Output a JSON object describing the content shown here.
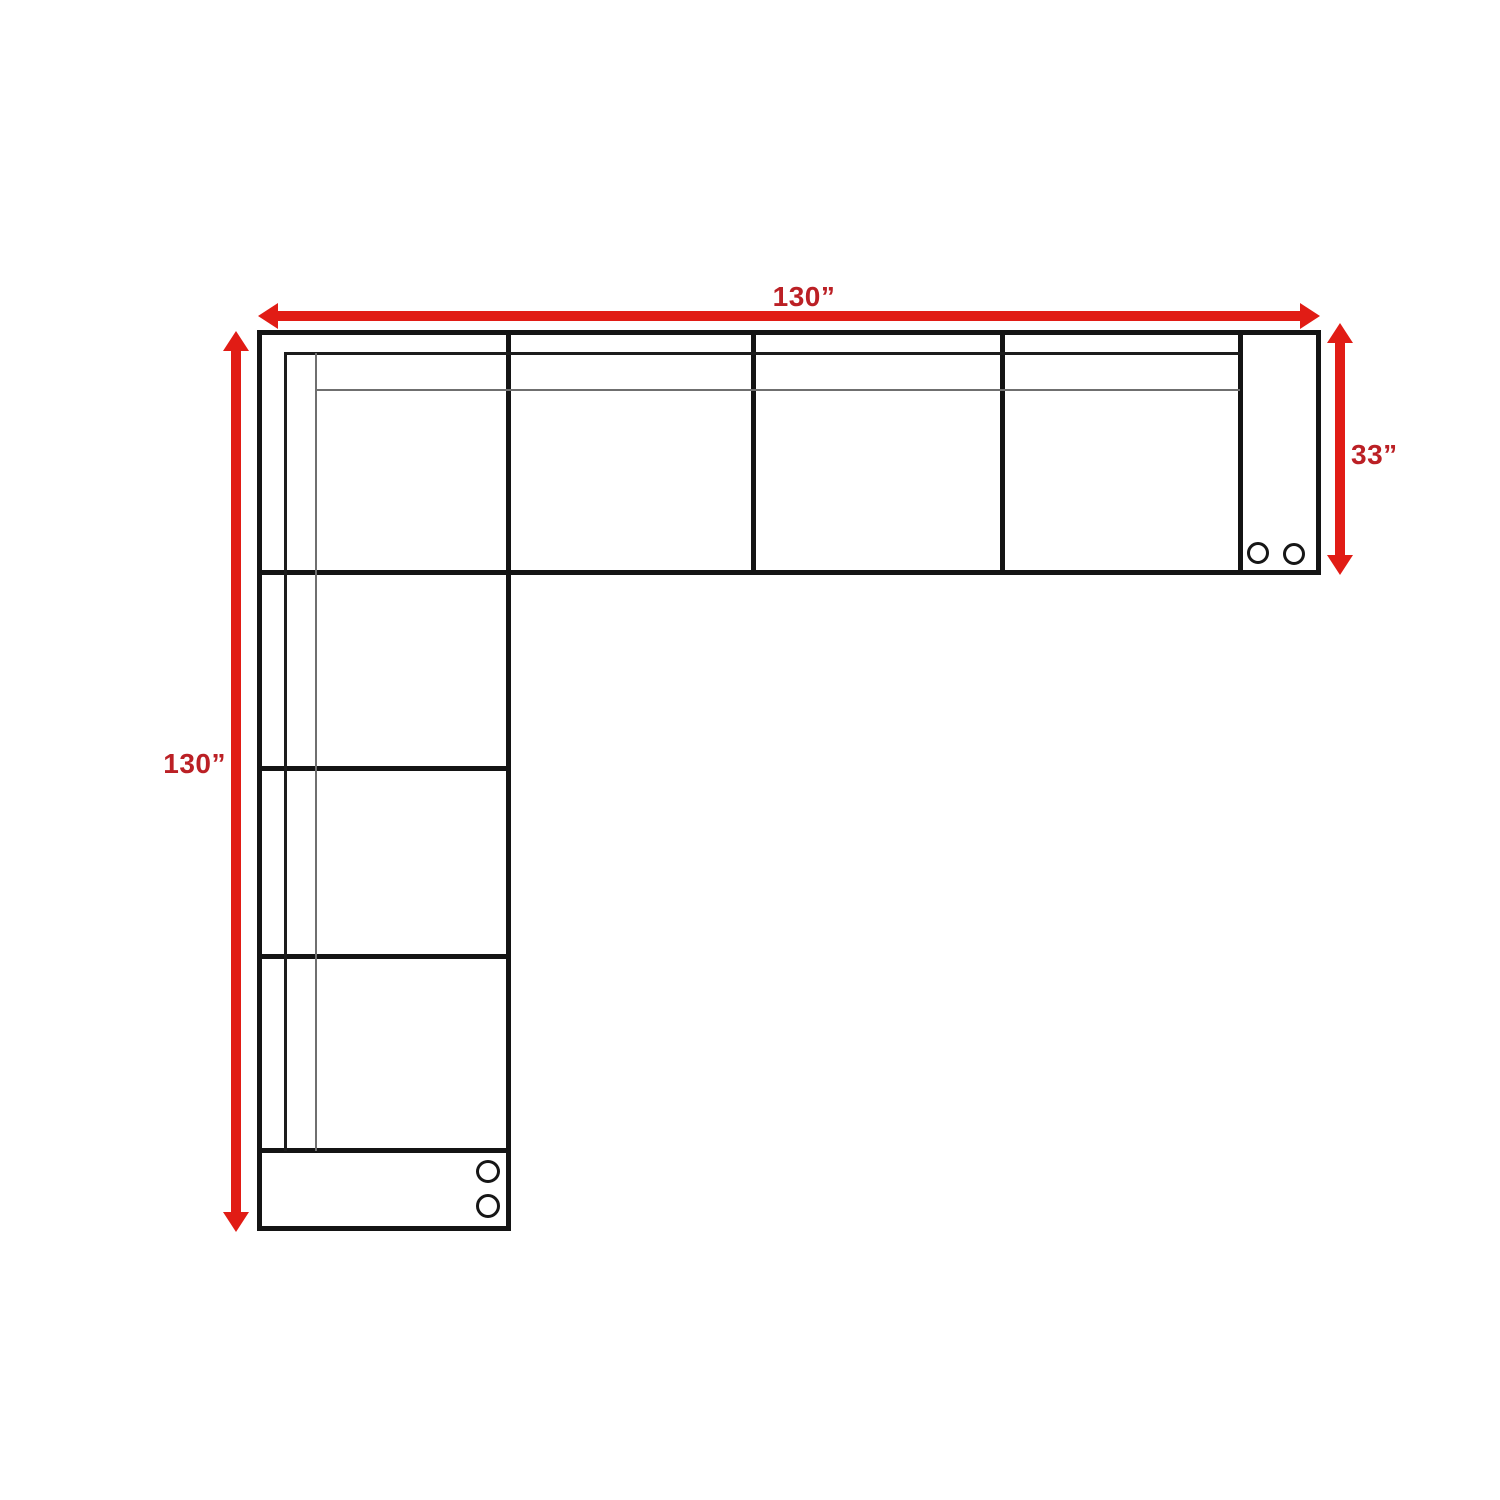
{
  "diagram": {
    "dimension_labels": {
      "top_width": "130”",
      "left_height": "130”",
      "right_depth": "33”"
    },
    "colors": {
      "arrow_red": "#e11c15",
      "label_red": "#bb2025",
      "outline_black": "#141414",
      "backrest_line_gray": "#6f6f6f",
      "background": "#ffffff"
    },
    "icons": {
      "cupholder": "circle-outline"
    }
  }
}
